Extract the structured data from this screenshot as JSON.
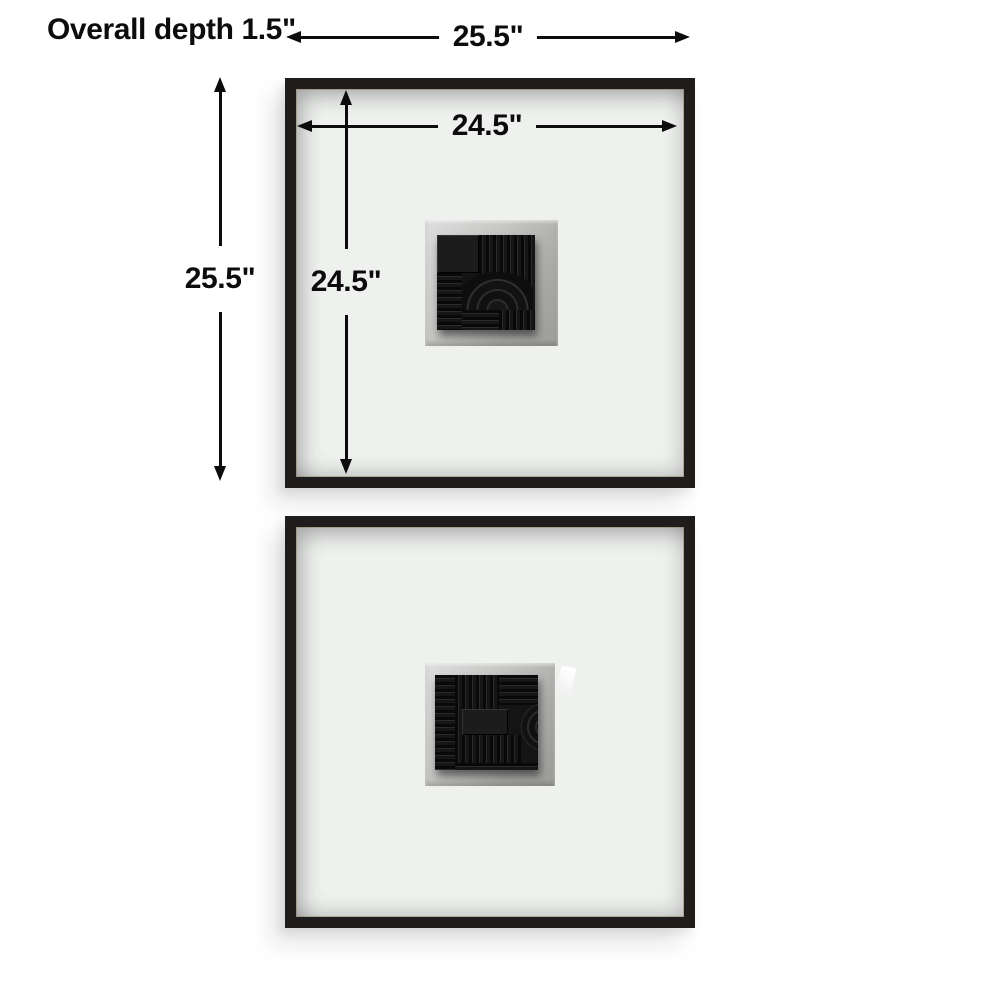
{
  "scene": {
    "description": "Product dimension diagram: set of two square black shadowbox wall-art frames with white mats and black geometric relief tiles",
    "annotations": {
      "overall_depth": "Overall depth 1.5\"",
      "outer_width": "25.5\"",
      "outer_height": "25.5\"",
      "inner_width": "24.5\"",
      "inner_height": "24.5\""
    },
    "colors": {
      "background": "#ffffff",
      "annotation_ink": "#0c0c0c",
      "frame": "#1f1d1c",
      "mat": "#eff1ef",
      "recess_gray": "#b4b4b2",
      "art_tile": "#141414"
    },
    "frames": [
      {
        "id": "top",
        "art": "black relief tile: solid block, vertical ribs, arch with concentric rings, horizontal ribs"
      },
      {
        "id": "bottom",
        "art": "black relief tile: ribbed stripes, solid center bar, partial concentric circle at right edge"
      }
    ]
  }
}
